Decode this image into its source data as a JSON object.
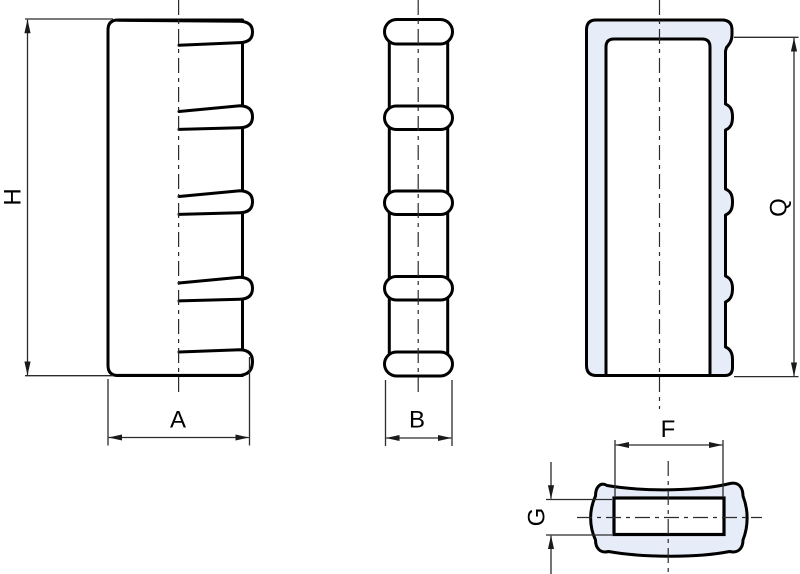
{
  "drawing": {
    "views": {
      "front": {
        "height_label": "H",
        "width_label": "A"
      },
      "side": {
        "width_label": "B"
      },
      "section": {
        "height_label": "Q"
      },
      "top": {
        "inner_width_label": "F",
        "inner_height_label": "G"
      }
    },
    "colors": {
      "background": "#ffffff",
      "outline": "#000000",
      "section_fill": "#e7edf8",
      "dim_line": "#2b2b2b",
      "label": "#000000"
    }
  }
}
